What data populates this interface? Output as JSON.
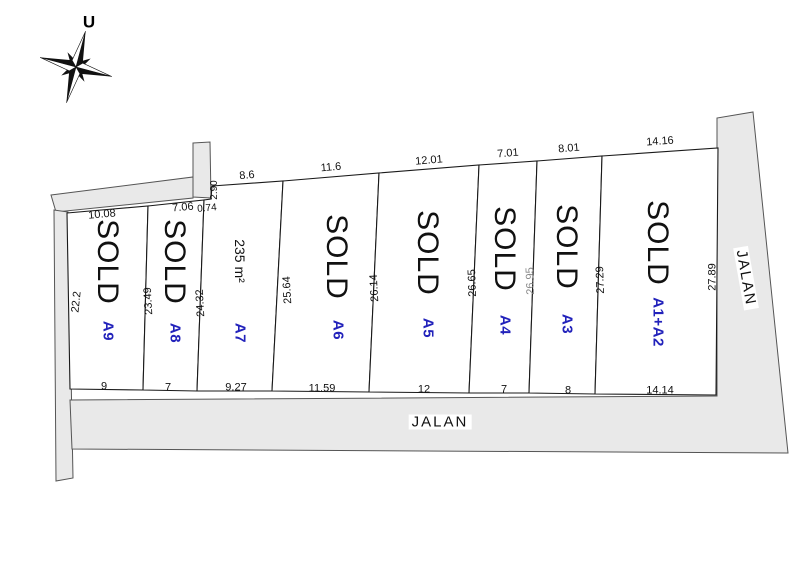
{
  "compass": {
    "north_label": "U"
  },
  "roads": {
    "bottom_label": "JALAN",
    "right_label": "JALAN"
  },
  "colors": {
    "plot_label": "#2222bb",
    "road_fill": "#e9e9e9",
    "road_stroke": "#555555",
    "line": "#1a1a1a",
    "text": "#111111",
    "dim_faint": "#8a8a8a"
  },
  "plots": [
    {
      "label": "A9",
      "status": "SOLD",
      "top_dim": "10.08",
      "bottom_dim": "9",
      "left_dim": "22.2"
    },
    {
      "label": "A8",
      "status": "SOLD",
      "top_dim": "7.06",
      "bottom_dim": "7",
      "left_dim": "23.49"
    },
    {
      "label": "A7",
      "status": "",
      "area": "235 m²",
      "top_dim": "8.6",
      "bottom_dim": "9.27",
      "left_dim": "24.32",
      "jog_dim_h": "0.74",
      "jog_dim_v": "2.90"
    },
    {
      "label": "A6",
      "status": "SOLD",
      "top_dim": "11.6",
      "bottom_dim": "11.59",
      "left_dim": "25.64"
    },
    {
      "label": "A5",
      "status": "SOLD",
      "top_dim": "12.01",
      "bottom_dim": "12",
      "left_dim": "26.14"
    },
    {
      "label": "A4",
      "status": "SOLD",
      "top_dim": "7.01",
      "bottom_dim": "7",
      "left_dim": "26.65"
    },
    {
      "label": "A3",
      "status": "SOLD",
      "top_dim": "8.01",
      "bottom_dim": "8",
      "left_dim": "26.95"
    },
    {
      "label": "A1+A2",
      "status": "SOLD",
      "top_dim": "14.16",
      "bottom_dim": "14.14",
      "left_dim": "27.29",
      "right_dim": "27.89"
    }
  ]
}
